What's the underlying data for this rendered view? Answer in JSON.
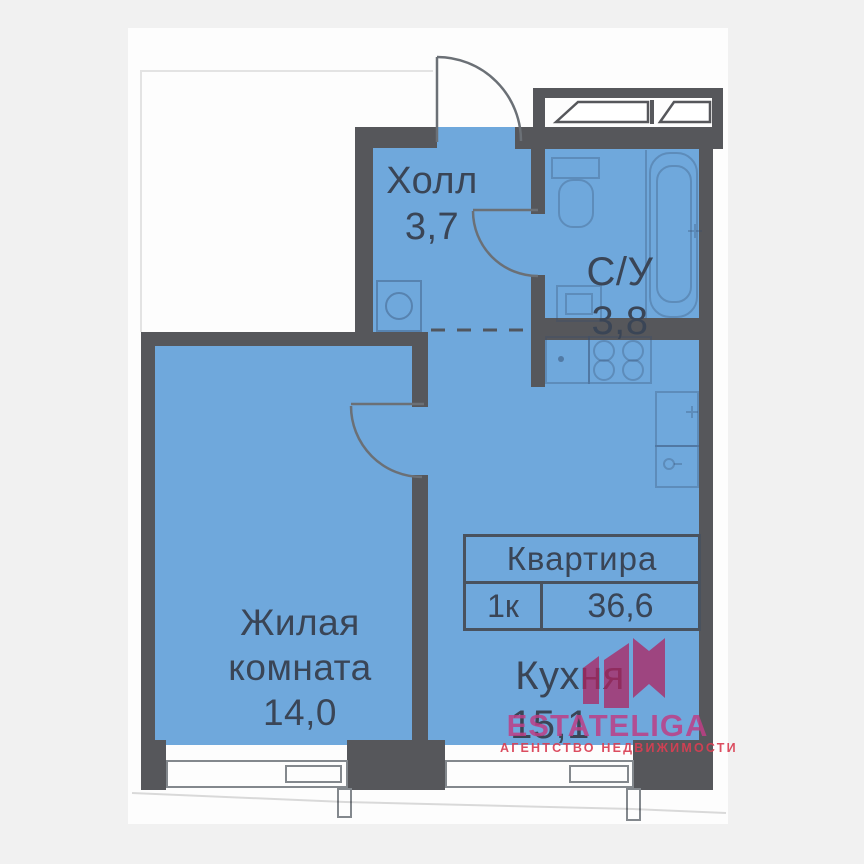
{
  "plan": {
    "type": "apartment-floor-plan",
    "rooms": {
      "hall": {
        "name": "Холл",
        "area": "3,7"
      },
      "bathroom": {
        "name": "С/У",
        "area": "3,8"
      },
      "living": {
        "name": "Жилая комната",
        "area": "14,0"
      },
      "kitchen": {
        "name": "Кухня",
        "area": "15,1"
      }
    },
    "summary": {
      "title": "Квартира",
      "rooms_label": "1к",
      "total_area": "36,6"
    },
    "fixtures": [
      "entry-door-swing",
      "bathroom-door-swing",
      "living-room-door-swing",
      "open-passage-dashed-line",
      "washing-machine",
      "toilet",
      "bathroom-sink",
      "bathtub",
      "kitchen-sink",
      "stove-4-burner",
      "kitchen-counter-units",
      "ventilation-shaft",
      "window-living-room",
      "window-kitchen"
    ]
  },
  "watermark": {
    "brand": "ESTATELIGA",
    "tagline": "АГЕНТСТВО НЕДВИЖИМОСТИ"
  },
  "colors": {
    "floor_blue": "#6fa8dc",
    "wall_gray": "#56575b",
    "label_text": "#3a4556",
    "logo_pink": "#bd3e86",
    "tagline_red": "#d93e52",
    "background": "#f1f1f1",
    "paper": "#fdfdfd"
  }
}
